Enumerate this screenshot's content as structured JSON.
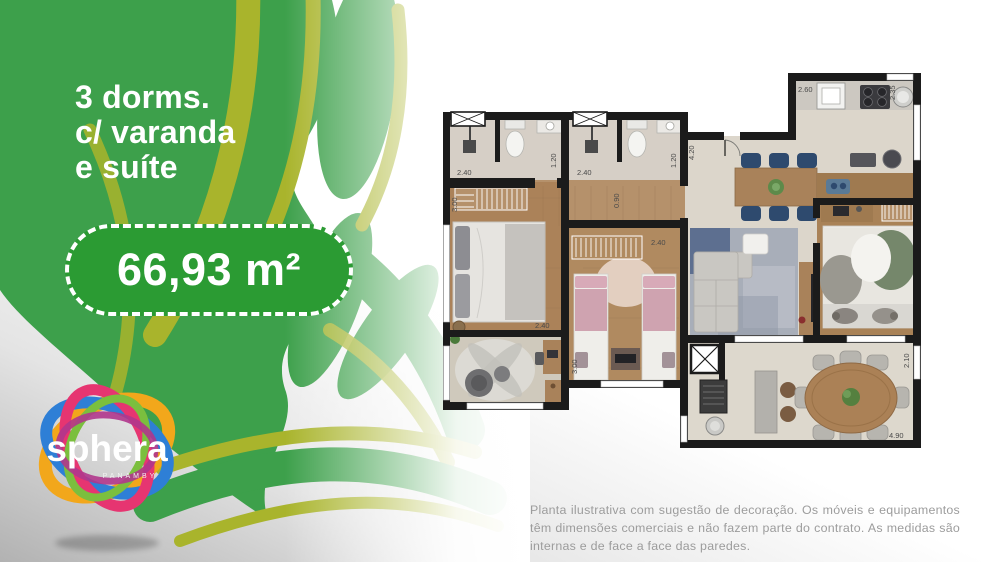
{
  "left_panel": {
    "headline": {
      "line1": "3 dorms.",
      "line2": "c/ varanda",
      "line3": "e suíte"
    },
    "area_badge": {
      "value": "66,93 m²"
    },
    "logo": {
      "name": "sphera",
      "subtitle": "PANAMBY"
    }
  },
  "floor_plan": {
    "dimensions": [
      {
        "room": "bathroom-1",
        "label": "2.40"
      },
      {
        "room": "bathroom-1",
        "label": "1.20"
      },
      {
        "room": "bathroom-2",
        "label": "2.40"
      },
      {
        "room": "bathroom-2",
        "label": "1.20"
      },
      {
        "room": "master-closet",
        "label": "3.00"
      },
      {
        "room": "hallway",
        "label": "0.90"
      },
      {
        "room": "master-bedroom",
        "label": "2.40"
      },
      {
        "room": "twin-bedroom",
        "label": "2.40"
      },
      {
        "room": "twin-bedroom",
        "label": "3.00"
      },
      {
        "room": "living-dining",
        "label": "4.20"
      },
      {
        "room": "kitchen",
        "label": "2.60"
      },
      {
        "room": "kitchen",
        "label": "2.35"
      },
      {
        "room": "balcony",
        "label": "2.10"
      },
      {
        "room": "balcony",
        "label": "4.90"
      }
    ]
  },
  "disclaimer": {
    "line1": "Planta ilustrativa com sugestão de decoração. Os móveis e equipamentos",
    "line2": "têm dimensões comerciais e não fazem parte do contrato. As medidas são",
    "line3": "internas e de face a face das paredes."
  },
  "colors": {
    "leaf_green": "#3da04b",
    "leaf_olive": "#a9b42c",
    "badge_green": "#2b9b33",
    "wall_black": "#1b1b1b",
    "disclaimer_gray": "#9c9c9c",
    "stool_navy": "#2e4a6e"
  }
}
